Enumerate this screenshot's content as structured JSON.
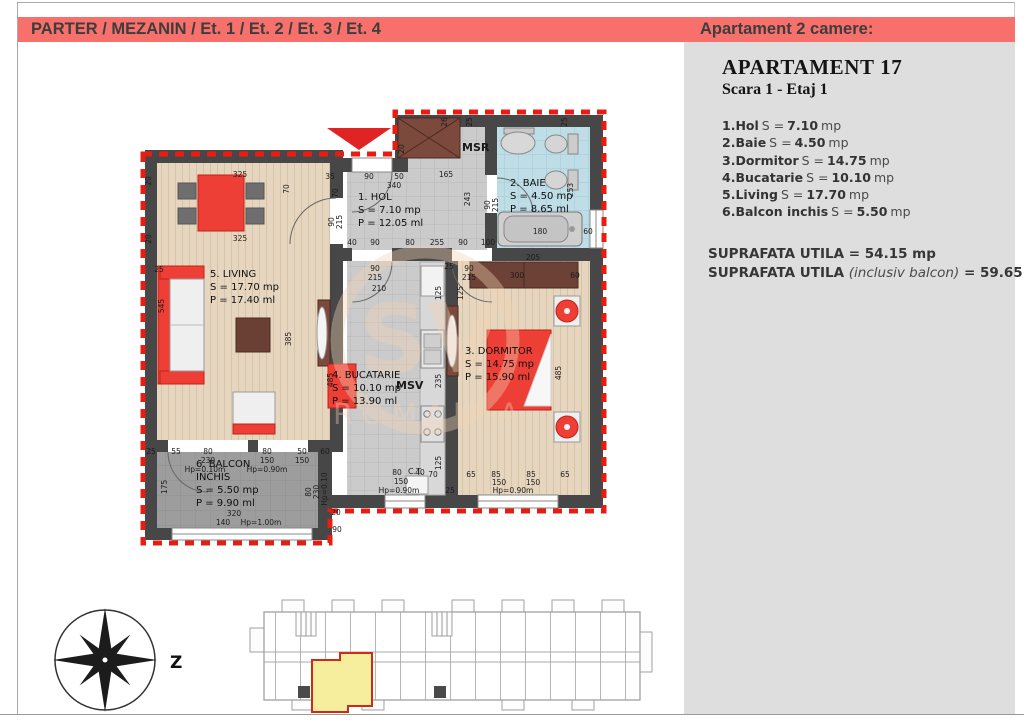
{
  "header": {
    "floors_title": "PARTER / MEZANIN / Et. 1 / Et. 2 / Et. 3 / Et. 4",
    "panel_title": "Apartament 2 camere:"
  },
  "panel": {
    "title": "APARTAMENT 17",
    "subtitle": "Scara 1 - Etaj 1",
    "rooms": [
      {
        "name": "1.Hol",
        "eq": "S =",
        "value": "7.10",
        "unit": "mp"
      },
      {
        "name": "2.Baie",
        "eq": "S =",
        "value": "4.50",
        "unit": "mp"
      },
      {
        "name": "3.Dormitor",
        "eq": "S =",
        "value": "14.75",
        "unit": "mp"
      },
      {
        "name": "4.Bucatarie",
        "eq": "S =",
        "value": "10.10",
        "unit": "mp"
      },
      {
        "name": "5.Living",
        "eq": "S =",
        "value": "17.70",
        "unit": "mp"
      },
      {
        "name": "6.Balcon inchis",
        "eq": "S =",
        "value": "5.50",
        "unit": "mp"
      }
    ],
    "totals": {
      "l1_label": "SUPRAFATA UTILA",
      "l1_eq": "=",
      "l1_value": "54.15 mp",
      "l2_label": "SUPRAFATA UTILA",
      "l2_note": "(inclusiv balcon)",
      "l2_eq": "=",
      "l2_value": "59.65 mp"
    }
  },
  "plan": {
    "rooms": {
      "hol": {
        "line1": "1. HOL",
        "line2": "S = 7.10 mp",
        "line3": "P = 12.05 ml"
      },
      "baie": {
        "line1": "2. BAIE",
        "line2": "S = 4.50 mp",
        "line3": "P = 8.65 ml"
      },
      "dormitor": {
        "line1": "3. DORMITOR",
        "line2": "S = 14.75 mp",
        "line3": "P = 15.90 ml"
      },
      "bucatarie": {
        "line1": "4. BUCATARIE",
        "line2": "S = 10.10 mp",
        "line3": "P = 13.90 ml"
      },
      "living": {
        "line1": "5. LIVING",
        "line2": "S = 17.70 mp",
        "line3": "P = 17.40 ml"
      },
      "balcon": {
        "line1": "6. BALCON",
        "line2": "INCHIS",
        "line3": "S = 5.50 mp",
        "line4": "P = 9.90 ml"
      }
    },
    "labels": {
      "msr": "MSR",
      "msv": "MSV",
      "ct": "C.T."
    },
    "watermark": {
      "big": "SV",
      "small": "ROMANIA"
    },
    "dimensions": [
      {
        "t": "35",
        "x": 330,
        "y": 179
      },
      {
        "t": "90",
        "x": 369,
        "y": 179
      },
      {
        "t": "50",
        "x": 399,
        "y": 179
      },
      {
        "t": "340",
        "x": 394,
        "y": 188
      },
      {
        "t": "165",
        "x": 446,
        "y": 177
      },
      {
        "t": "20",
        "x": 404,
        "y": 149,
        "r": -90
      },
      {
        "t": "26",
        "x": 447,
        "y": 122,
        "r": -90
      },
      {
        "t": "25",
        "x": 472,
        "y": 122,
        "r": -90
      },
      {
        "t": "25",
        "x": 567,
        "y": 122,
        "r": -90
      },
      {
        "t": "70",
        "x": 338,
        "y": 193,
        "r": -90
      },
      {
        "t": "70",
        "x": 289,
        "y": 189,
        "r": -90
      },
      {
        "t": "90",
        "x": 334,
        "y": 222,
        "r": -90
      },
      {
        "t": "215",
        "x": 342,
        "y": 222,
        "r": -90
      },
      {
        "t": "243",
        "x": 470,
        "y": 199,
        "r": -90
      },
      {
        "t": "90",
        "x": 490,
        "y": 205,
        "r": -90
      },
      {
        "t": "215",
        "x": 498,
        "y": 205,
        "r": -90
      },
      {
        "t": "40",
        "x": 352,
        "y": 245
      },
      {
        "t": "90",
        "x": 375,
        "y": 245
      },
      {
        "t": "80",
        "x": 410,
        "y": 245
      },
      {
        "t": "255",
        "x": 437,
        "y": 245
      },
      {
        "t": "90",
        "x": 463,
        "y": 245
      },
      {
        "t": "100",
        "x": 488,
        "y": 245
      },
      {
        "t": "90",
        "x": 375,
        "y": 271
      },
      {
        "t": "215",
        "x": 375,
        "y": 280
      },
      {
        "t": "210",
        "x": 379,
        "y": 291
      },
      {
        "t": "90",
        "x": 469,
        "y": 271
      },
      {
        "t": "215",
        "x": 469,
        "y": 280
      },
      {
        "t": "25",
        "x": 449,
        "y": 269
      },
      {
        "t": "125",
        "x": 441,
        "y": 293,
        "r": -90
      },
      {
        "t": "180",
        "x": 540,
        "y": 234
      },
      {
        "t": "60",
        "x": 588,
        "y": 234
      },
      {
        "t": "253",
        "x": 573,
        "y": 190,
        "r": -90
      },
      {
        "t": "325",
        "x": 240,
        "y": 177
      },
      {
        "t": "325",
        "x": 240,
        "y": 241
      },
      {
        "t": "20",
        "x": 151,
        "y": 181,
        "r": -90
      },
      {
        "t": "20",
        "x": 151,
        "y": 239,
        "r": -90
      },
      {
        "t": "25",
        "x": 159,
        "y": 272
      },
      {
        "t": "545",
        "x": 164,
        "y": 306,
        "r": -90
      },
      {
        "t": "385",
        "x": 291,
        "y": 339,
        "r": -90
      },
      {
        "t": "25",
        "x": 151,
        "y": 454
      },
      {
        "t": "55",
        "x": 176,
        "y": 454
      },
      {
        "t": "80",
        "x": 208,
        "y": 454
      },
      {
        "t": "230",
        "x": 208,
        "y": 463
      },
      {
        "t": "Hp=0.10m",
        "x": 205,
        "y": 472
      },
      {
        "t": "80",
        "x": 267,
        "y": 454
      },
      {
        "t": "150",
        "x": 267,
        "y": 463
      },
      {
        "t": "Hp=0.90m",
        "x": 267,
        "y": 472
      },
      {
        "t": "50",
        "x": 302,
        "y": 454
      },
      {
        "t": "150",
        "x": 302,
        "y": 463
      },
      {
        "t": "60",
        "x": 325,
        "y": 454
      },
      {
        "t": "175",
        "x": 167,
        "y": 487,
        "r": -90
      },
      {
        "t": "320",
        "x": 234,
        "y": 516
      },
      {
        "t": "140",
        "x": 223,
        "y": 525
      },
      {
        "t": "Hp=1.00m",
        "x": 261,
        "y": 525
      },
      {
        "t": "80",
        "x": 311,
        "y": 492,
        "r": -90
      },
      {
        "t": "230",
        "x": 319,
        "y": 492,
        "r": -90
      },
      {
        "t": "Hp=0.10",
        "x": 327,
        "y": 489,
        "r": -90
      },
      {
        "t": "20",
        "x": 336,
        "y": 515
      },
      {
        "t": "90",
        "x": 337,
        "y": 532
      },
      {
        "t": "485",
        "x": 333,
        "y": 380,
        "r": -90
      },
      {
        "t": "235",
        "x": 441,
        "y": 381,
        "r": -90
      },
      {
        "t": "125",
        "x": 441,
        "y": 463,
        "r": -90
      },
      {
        "t": "80",
        "x": 397,
        "y": 475
      },
      {
        "t": "40",
        "x": 420,
        "y": 475
      },
      {
        "t": "150",
        "x": 401,
        "y": 484
      },
      {
        "t": "Hp=0.90m",
        "x": 399,
        "y": 493
      },
      {
        "t": "70",
        "x": 433,
        "y": 477
      },
      {
        "t": "25",
        "x": 450,
        "y": 493
      },
      {
        "t": "205",
        "x": 533,
        "y": 260
      },
      {
        "t": "300",
        "x": 517,
        "y": 278
      },
      {
        "t": "60",
        "x": 575,
        "y": 278
      },
      {
        "t": "125",
        "x": 463,
        "y": 293,
        "r": -90
      },
      {
        "t": "485",
        "x": 561,
        "y": 373,
        "r": -90
      },
      {
        "t": "65",
        "x": 471,
        "y": 477
      },
      {
        "t": "85",
        "x": 496,
        "y": 477
      },
      {
        "t": "150",
        "x": 499,
        "y": 485
      },
      {
        "t": "85",
        "x": 531,
        "y": 477
      },
      {
        "t": "150",
        "x": 533,
        "y": 485
      },
      {
        "t": "65",
        "x": 565,
        "y": 477
      },
      {
        "t": "Hp=0.90m",
        "x": 513,
        "y": 493
      }
    ]
  },
  "overview": {
    "compass_label": "Z"
  },
  "colors": {
    "header_bar": "#f8706b",
    "panel_bg": "#dedede",
    "plan_red": "#ee3f36",
    "dashed_outline": "#ea1c12",
    "highlight_yellow": "#f6ee9c",
    "wall": "#474747"
  }
}
